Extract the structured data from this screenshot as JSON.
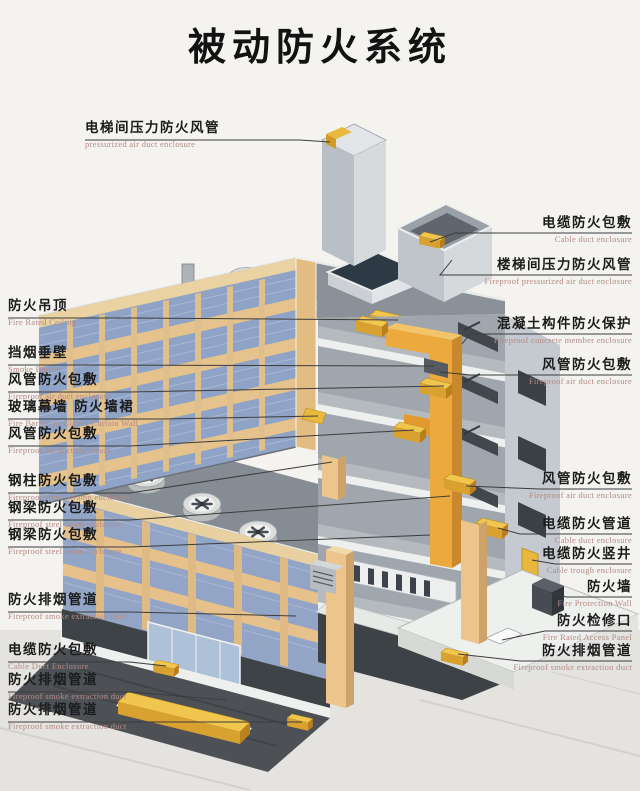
{
  "title": "被动防火系统",
  "colors": {
    "background": "#f4f3ef",
    "label_text": "#1c1c1c",
    "label_sub_text": "#b48a85",
    "leader_line": "#3c3c3c",
    "curtain_glass": "#8fa3c6",
    "mullion_tan": "#e6c28c",
    "duct_yellow": "#f1c64e",
    "riser_orange": "#ecaa3e",
    "concrete_gray": "#8d939a",
    "dark_basement": "#4d5156"
  },
  "labels": {
    "left": [
      {
        "zh": "电梯间压力防火风管",
        "en": "pressurized air duct enclosure"
      },
      {
        "zh": "防火吊顶",
        "en": "Fire Rated Ceiling"
      },
      {
        "zh": "挡烟垂壁",
        "en": "Smoke Barrier"
      },
      {
        "zh": "风管防火包敷",
        "en": "Fireproof air duct enclosure"
      },
      {
        "zh": "玻璃幕墙 防火墙裙",
        "en": "Fire Barrier at Glazed Curtain Wall"
      },
      {
        "zh": "风管防火包敷",
        "en": "Fireproof air duct enclosure"
      },
      {
        "zh": "钢柱防火包敷",
        "en": "Fireproof steel column enclosure"
      },
      {
        "zh": "钢梁防火包敷",
        "en": "Fireproof steel beam enclosure"
      },
      {
        "zh": "钢梁防火包敷",
        "en": "Fireproof steel beam enclosure"
      },
      {
        "zh": "防火排烟管道",
        "en": "Fireproof smoke extraction duct"
      },
      {
        "zh": "电缆防火包敷",
        "en": "Cable Duct Enclosure"
      },
      {
        "zh": "防火排烟管道",
        "en": "Fireproof smoke extraction duct"
      },
      {
        "zh": "防火排烟管道",
        "en": "Fireproof smoke extraction duct"
      }
    ],
    "right": [
      {
        "zh": "电缆防火包敷",
        "en": "Cable duct enclosure"
      },
      {
        "zh": "楼梯间压力防火风管",
        "en": "Fireproof pressurized air duct enclosure"
      },
      {
        "zh": "混凝土构件防火保护",
        "en": "Fireproof concrete member enclosure"
      },
      {
        "zh": "风管防火包敷",
        "en": "Fireproof air duct enclosure"
      },
      {
        "zh": "风管防火包敷",
        "en": "Fireproof air duct enclosure"
      },
      {
        "zh": "电缆防火管道",
        "en": "Cable duct enclosure"
      },
      {
        "zh": "电缆防火竖井",
        "en": "Cable trough enclosure"
      },
      {
        "zh": "防火墙",
        "en": "Fire Protection Wall"
      },
      {
        "zh": "防火检修口",
        "en": "Fire Rated Access Panel"
      },
      {
        "zh": "防火排烟管道",
        "en": "Fireproof smoke extraction duct"
      }
    ]
  }
}
